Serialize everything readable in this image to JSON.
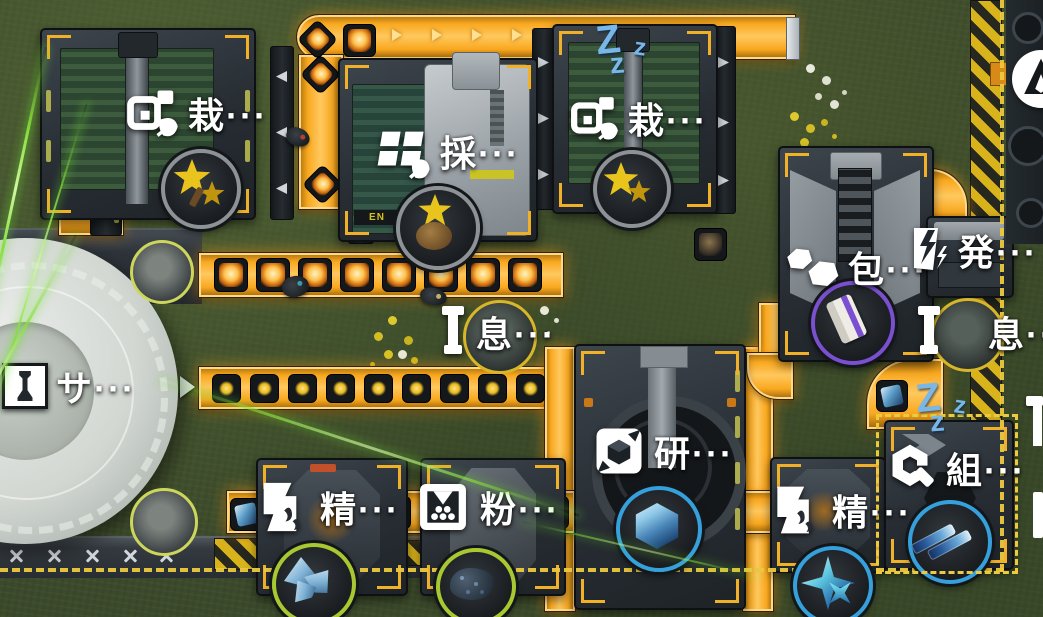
{
  "scene": {
    "type": "factory-base-overview",
    "territory_border": "dashed-yellow",
    "time_of_day": "day"
  },
  "colors": {
    "belt_orange": "#f9a81f",
    "belt_highlight": "#ffd98a",
    "hazard_yellow": "#d9b31c",
    "border_dash": "#ecc93f",
    "idle_zzz_blue": "#79b7e8",
    "label_text": "#ffffff",
    "ring_gray": "#8d9296",
    "ring_purple": "#7a4fd0",
    "ring_blue": "#35a0dc",
    "ring_lime": "#a8c832",
    "laser_green": "#86e03a"
  },
  "buildings": [
    {
      "id": "cultivator-1",
      "label": "栽···",
      "icon": "cultivate-icon",
      "output_item": "yellow-flower",
      "ring": "#8d9296"
    },
    {
      "id": "harvester",
      "label": "採···",
      "icon": "harvest-icon",
      "output_item": "yellow-flower-bulb",
      "ring": "#8d9296"
    },
    {
      "id": "cultivator-2",
      "label": "栽···",
      "icon": "cultivate-icon",
      "output_item": "yellow-flower",
      "ring": "#8d9296",
      "status": "idle"
    },
    {
      "id": "packer",
      "label": "包···",
      "icon": "package-icon",
      "output_item": "packaged-box",
      "ring": "#7a4fd0"
    },
    {
      "id": "generator",
      "label": "発···",
      "icon": "power-icon"
    },
    {
      "id": "pylon-left",
      "label": "息···",
      "icon": "pylon-icon"
    },
    {
      "id": "pylon-right",
      "label": "息···",
      "icon": "pylon-icon"
    },
    {
      "id": "silo-dome",
      "label": "サ···",
      "icon": "silo-icon"
    },
    {
      "id": "shaper",
      "label": "研···",
      "icon": "shaper-icon",
      "output_item": "blue-cube",
      "ring": "#35a0dc"
    },
    {
      "id": "refiner-left",
      "label": "精···",
      "icon": "refine-icon",
      "output_item": "crystal-shards",
      "ring": "#a8c832"
    },
    {
      "id": "crusher",
      "label": "粉···",
      "icon": "crush-icon",
      "output_item": "ore-rock",
      "ring": "#a8c832"
    },
    {
      "id": "refiner-right",
      "label": "精···",
      "icon": "refine-icon",
      "output_item": "star-crystal",
      "ring": "#35a0dc"
    },
    {
      "id": "assembler",
      "label": "組···",
      "icon": "assemble-icon",
      "output_item": "component-rods",
      "ring": "#35a0dc",
      "status": "idle",
      "selected": true
    }
  ],
  "indicators": {
    "idle_z_big": "Z",
    "idle_z_mid": "z",
    "idle_z_small": "z"
  },
  "decals": {
    "harvester_text": "EN"
  }
}
